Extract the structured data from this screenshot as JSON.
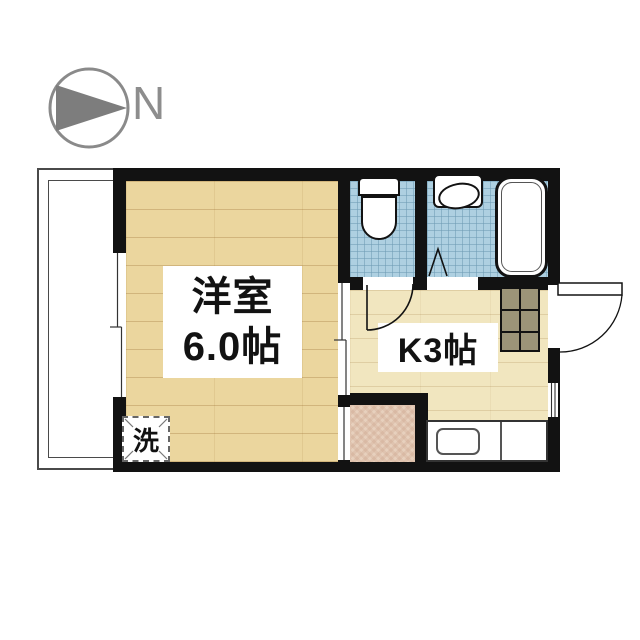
{
  "compass": {
    "label": "N"
  },
  "rooms": {
    "western_room": {
      "name": "洋室",
      "size": "6.0帖"
    },
    "kitchen": {
      "label": "K3帖"
    },
    "washer": {
      "label": "洗"
    }
  },
  "fixtures": [
    "toilet",
    "bathtub",
    "wash-basin",
    "kitchen-sink-counter",
    "shoe-cabinet",
    "washing-machine-space",
    "entrance-door",
    "sliding-window",
    "sliding-door",
    "folding-bath-door",
    "balcony"
  ],
  "colors": {
    "wall": "#121212",
    "wood_floor": "#ebd69e",
    "kitchen_floor": "#f1e6bf",
    "tile_blue": "#aed0e1",
    "entrance_tile_pink": "#e7d0bd",
    "cabinet_olive": "#9c9478",
    "compass_gray": "#8a8a8a",
    "background": "#ffffff"
  }
}
